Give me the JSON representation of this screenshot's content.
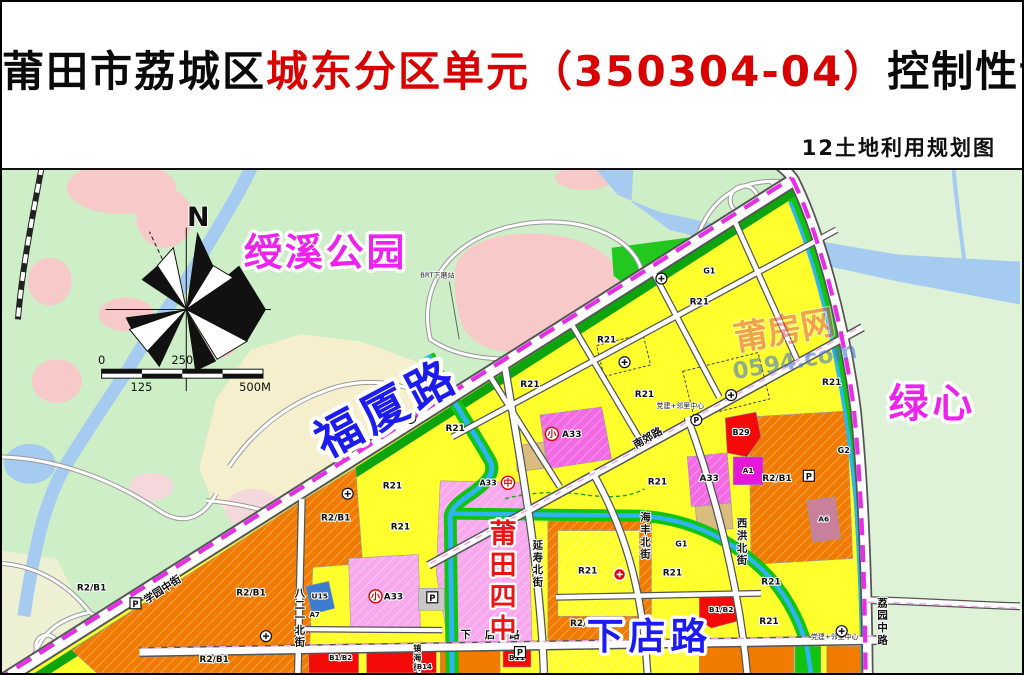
{
  "header": {
    "title_part1": "莆田市荔城区",
    "title_part2": "城东分区单元（350304-04）",
    "title_part3": "控制性详细规划",
    "subtitle": "12土地利用规划图"
  },
  "map": {
    "big_labels": {
      "north": {
        "text": "N",
        "x": 197,
        "y": 56,
        "fs": 27,
        "color": "#111111",
        "halo": 2
      },
      "park": {
        "text": "绶溪公园",
        "x": 325,
        "y": 96,
        "fs": 38,
        "color": "magenta",
        "ls": 3
      },
      "fuxia": {
        "text": "福厦路",
        "x": 394,
        "y": 253,
        "fs": 46,
        "color": "blue",
        "rotate": -28,
        "ls": 6
      },
      "green_heart": {
        "text": "绿心",
        "x": 934,
        "y": 248,
        "fs": 40,
        "color": "magenta",
        "ls": 4
      },
      "school": {
        "text": "莆田四中",
        "x": 503,
        "y": 374,
        "fs": 27,
        "color": "red",
        "vertical": true
      },
      "xiadian": {
        "text": "下店路",
        "x": 650,
        "y": 481,
        "fs": 37,
        "color": "blue",
        "ls": 5
      }
    },
    "watermark": {
      "site_name": "莆房网",
      "site_url": "0594.com"
    },
    "scale_bar": {
      "t0": "0",
      "t125": "125",
      "t250": "250",
      "t500": "500M"
    },
    "zone_labels": [
      {
        "code": "R21",
        "x": 530,
        "y": 218
      },
      {
        "code": "R21",
        "x": 455,
        "y": 262
      },
      {
        "code": "R21",
        "x": 392,
        "y": 320
      },
      {
        "code": "R21",
        "x": 400,
        "y": 361
      },
      {
        "code": "R21",
        "x": 607,
        "y": 173
      },
      {
        "code": "R21",
        "x": 645,
        "y": 228
      },
      {
        "code": "R21",
        "x": 700,
        "y": 135
      },
      {
        "code": "R21",
        "x": 833,
        "y": 216
      },
      {
        "code": "R21",
        "x": 588,
        "y": 405
      },
      {
        "code": "R21",
        "x": 673,
        "y": 407
      },
      {
        "code": "R21",
        "x": 658,
        "y": 316
      },
      {
        "code": "R21",
        "x": 772,
        "y": 416
      },
      {
        "code": "R21",
        "x": 770,
        "y": 456
      },
      {
        "code": "R2/B1",
        "x": 90,
        "y": 422
      },
      {
        "code": "R2/B1",
        "x": 335,
        "y": 352
      },
      {
        "code": "R2/B1",
        "x": 250,
        "y": 427
      },
      {
        "code": "R2/B1",
        "x": 213,
        "y": 494
      },
      {
        "code": "R2/B1",
        "x": 585,
        "y": 458
      },
      {
        "code": "R2/B1",
        "x": 778,
        "y": 312
      },
      {
        "code": "A33",
        "x": 572,
        "y": 268
      },
      {
        "code": "A33",
        "x": 710,
        "y": 312
      },
      {
        "code": "A33",
        "x": 393,
        "y": 431
      },
      {
        "code": "A33",
        "x": 488,
        "y": 317,
        "fs": 8
      },
      {
        "code": "B29",
        "x": 742,
        "y": 266,
        "fs": 8
      },
      {
        "code": "A1",
        "x": 749,
        "y": 304,
        "fs": 7.5
      },
      {
        "code": "U15",
        "x": 319,
        "y": 430,
        "fs": 7.5
      },
      {
        "code": "A7",
        "x": 314,
        "y": 449,
        "fs": 7
      },
      {
        "code": "B11",
        "x": 517,
        "y": 492,
        "fs": 7.5
      },
      {
        "code": "B1/B2",
        "x": 340,
        "y": 492,
        "fs": 7
      },
      {
        "code": "B1/B2",
        "x": 722,
        "y": 444,
        "fs": 7.5
      },
      {
        "code": "B14",
        "x": 424,
        "y": 501,
        "fs": 7
      },
      {
        "code": "A6",
        "x": 825,
        "y": 353,
        "fs": 7.5
      },
      {
        "code": "G1",
        "x": 710,
        "y": 104,
        "fs": 8
      },
      {
        "code": "G1",
        "x": 682,
        "y": 378,
        "fs": 8
      },
      {
        "code": "G2",
        "x": 845,
        "y": 284,
        "fs": 8
      }
    ],
    "street_labels": [
      {
        "text": "延寿北街",
        "x": 538,
        "y": 380,
        "vertical": true
      },
      {
        "text": "海丰北街",
        "x": 646,
        "y": 352,
        "vertical": true
      },
      {
        "text": "西洪北街",
        "x": 743,
        "y": 358,
        "vertical": true
      },
      {
        "text": "八二一北街",
        "x": 299,
        "y": 428,
        "vertical": true
      },
      {
        "text": "荔园中路",
        "x": 884,
        "y": 438,
        "vertical": true
      },
      {
        "text": "镇海街",
        "x": 417,
        "y": 483,
        "vertical": true,
        "fs": 8
      },
      {
        "text": "学园中街",
        "x": 163,
        "y": 424,
        "rotate": -33
      },
      {
        "text": "南郊路",
        "x": 650,
        "y": 272,
        "rotate": -29
      },
      {
        "text": "下店路",
        "x": 497,
        "y": 470,
        "ls": 14
      }
    ],
    "annotations": [
      {
        "text": "BRT下磨站",
        "x": 437,
        "y": 108
      },
      {
        "text": "党建+邻里中心",
        "x": 681,
        "y": 239
      },
      {
        "text": "党建+邻里中心",
        "x": 836,
        "y": 471
      }
    ],
    "icons": [
      {
        "type": "school",
        "char": "中",
        "x": 508,
        "y": 314
      },
      {
        "type": "school",
        "char": "小",
        "x": 552,
        "y": 265
      },
      {
        "type": "school",
        "char": "小",
        "x": 375,
        "y": 428
      },
      {
        "type": "facility",
        "x": 410,
        "y": 249
      },
      {
        "type": "facility",
        "x": 347,
        "y": 325
      },
      {
        "type": "facility",
        "x": 625,
        "y": 193
      },
      {
        "type": "facility",
        "x": 732,
        "y": 226
      },
      {
        "type": "facility",
        "x": 662,
        "y": 109
      },
      {
        "type": "facility",
        "x": 265,
        "y": 468
      },
      {
        "type": "facility",
        "x": 843,
        "y": 463
      },
      {
        "type": "pcircle",
        "x": 697,
        "y": 251
      },
      {
        "type": "pbox",
        "x": 810,
        "y": 307
      },
      {
        "type": "pbox",
        "x": 432,
        "y": 429
      },
      {
        "type": "pbox",
        "x": 134,
        "y": 435
      },
      {
        "type": "pbox",
        "x": 520,
        "y": 484
      },
      {
        "type": "redbadge",
        "x": 620,
        "y": 406
      }
    ],
    "colors": {
      "title_red": "#d90000",
      "bg_park": "#cdeec6",
      "bg_greenheart": "#ddf2d6",
      "bg_existing": "#f6efcd",
      "water": "#a6cbf0",
      "canal": "#2fb4f2",
      "zone_yellow": "#ffff2e",
      "zone_orange": "#f07b00",
      "zone_magenta": "#f36ae4",
      "zone_pink": "#f8a9ee",
      "zone_red": "#f50a0a",
      "zone_green": "#12c312",
      "zone_tan": "#dabd7e",
      "zone_mauve": "#c9809a",
      "zone_blue": "#3e7cd0",
      "boundary": "#e72ee7",
      "label_magenta": "#ee22ee",
      "label_blue": "#1c1cf0",
      "label_red": "#ea1515"
    }
  }
}
